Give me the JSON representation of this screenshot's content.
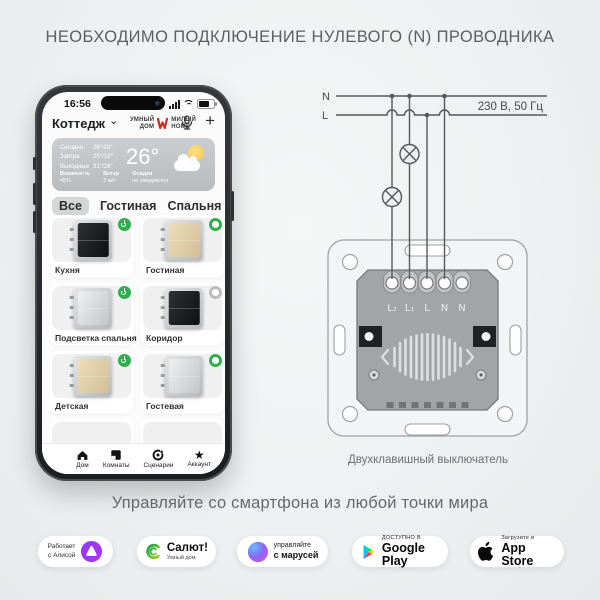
{
  "title": "НЕОБХОДИМО ПОДКЛЮЧЕНИЕ НУЛЕВОГО (N) ПРОВОДНИКА",
  "tagline": "Управляйте со смартфона из любой точки мира",
  "colors": {
    "accent_green": "#2fae4d",
    "brand_red": "#d5291c",
    "background": "#eef1f1",
    "title_gray": "#5b5f61"
  },
  "icons": {
    "plus": "+",
    "chevron": "⌄",
    "star": "★"
  },
  "phone": {
    "status_time": "16:56",
    "home_name": "Коттедж",
    "brand": {
      "line1": "УМНЫЙ",
      "line2": "ДОМ",
      "line3": "МИЛЫЙ",
      "line4": "HOME"
    },
    "weather": {
      "temp": "26°",
      "rows": [
        {
          "day": "Сегодня",
          "temp": "26°/20°"
        },
        {
          "day": "Завтра",
          "temp": "25°/18°"
        },
        {
          "day": "Выходные",
          "temp": "31°/26°"
        }
      ],
      "details": [
        {
          "label": "Влажность",
          "value": "45%"
        },
        {
          "label": "Ветер",
          "value": "3 м/с"
        },
        {
          "label": "Осадки",
          "value": "не ожидаются"
        }
      ]
    },
    "tabs": [
      "Все",
      "Гостиная",
      "Спальня",
      "Коридор"
    ],
    "devices": [
      {
        "name": "Кухня",
        "finish": "black",
        "power": "on"
      },
      {
        "name": "Гостиная",
        "finish": "gold",
        "power": "ring"
      },
      {
        "name": "Подсветка спальня",
        "finish": "silver",
        "power": "on"
      },
      {
        "name": "Коридор",
        "finish": "black",
        "power": "off"
      },
      {
        "name": "Детская",
        "finish": "gold",
        "power": "on"
      },
      {
        "name": "Гостевая",
        "finish": "silver",
        "power": "ring"
      }
    ],
    "nav": [
      {
        "label": "Дом"
      },
      {
        "label": "Комнаты"
      },
      {
        "label": "Сценарии"
      },
      {
        "label": "Аккаунт"
      }
    ]
  },
  "diagram": {
    "n": "N",
    "l": "L",
    "voltage": "230 В, 50 Гц",
    "terminals": [
      "L₂",
      "L₁",
      "L",
      "N",
      "N"
    ],
    "caption": "Двухклавишный выключатель"
  },
  "badges": {
    "alice": {
      "line1": "Работает",
      "line2": "с Алисой"
    },
    "salut": {
      "title": "Салют!",
      "subtitle": "Умный дом"
    },
    "marusia": {
      "line1": "управляйте",
      "line2": "с марусей"
    },
    "gplay": {
      "line1": "ДОСТУПНО В",
      "line2": "Google Play"
    },
    "appstore": {
      "line1": "Загрузите в",
      "line2": "App Store"
    }
  }
}
